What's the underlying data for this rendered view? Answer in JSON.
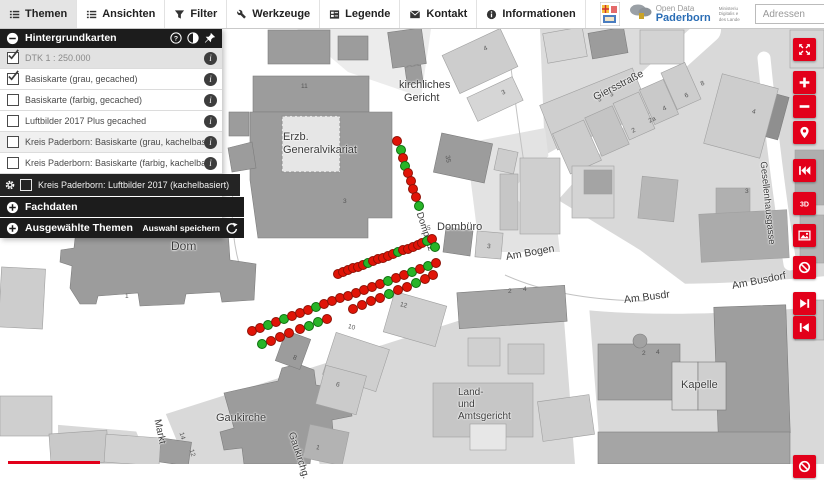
{
  "toolbar": {
    "tabs": [
      {
        "label": "Themen",
        "icon": "list-icon",
        "active": true
      },
      {
        "label": "Ansichten",
        "icon": "list-icon",
        "active": false
      },
      {
        "label": "Filter",
        "icon": "funnel-icon",
        "active": false
      },
      {
        "label": "Werkzeuge",
        "icon": "wrench-icon",
        "active": false
      },
      {
        "label": "Legende",
        "icon": "legend-icon",
        "active": false
      },
      {
        "label": "Kontakt",
        "icon": "mail-icon",
        "active": false
      },
      {
        "label": "Informationen",
        "icon": "info-icon",
        "active": false
      }
    ]
  },
  "brand": {
    "opendata_line1": "Open Data",
    "opendata_line2": "Paderborn",
    "ministry_lines": [
      "Ministeriu",
      "Digitalis e",
      "des Lande"
    ]
  },
  "search": {
    "placeholder": "Adressen",
    "value": ""
  },
  "panel": {
    "header": {
      "title": "Hintergrundkarten"
    },
    "layers": [
      {
        "label": "DTK 1 : 250.000",
        "checked": true,
        "muted": true,
        "info": true
      },
      {
        "label": "Basiskarte (grau, gecached)",
        "checked": true,
        "info": true
      },
      {
        "label": "Basiskarte (farbig, gecached)",
        "checked": false,
        "info": true
      },
      {
        "label": "Luftbilder 2017 Plus gecached",
        "checked": false,
        "info": true
      },
      {
        "label": "Kreis Paderborn: Basiskarte (grau, kachelbasiert)",
        "checked": false,
        "info": true,
        "shaded": true
      },
      {
        "label": "Kreis Paderborn: Basiskarte (farbig, kachelbasiert)",
        "checked": false,
        "info": true
      },
      {
        "label": "Kreis Paderborn: Luftbilder 2017 (kachelbasiert)",
        "checked": false,
        "dark": true,
        "gear": true
      }
    ],
    "sections": [
      {
        "label": "Fachdaten",
        "action": ""
      },
      {
        "label": "Ausgewählte Themen",
        "action": "Auswahl speichern"
      }
    ]
  },
  "map_controls": [
    {
      "name": "fullscreen",
      "icon": "expand-icon",
      "y": 38
    },
    {
      "name": "zoom-in",
      "icon": "plus-icon",
      "y": 71
    },
    {
      "name": "zoom-out",
      "icon": "minus-icon",
      "y": 95
    },
    {
      "name": "locate",
      "icon": "marker-icon",
      "y": 121
    },
    {
      "name": "back-to-start",
      "icon": "rewind-icon",
      "y": 159
    },
    {
      "name": "3d-view",
      "icon": "threed-icon",
      "y": 192
    },
    {
      "name": "background-image",
      "icon": "image-icon",
      "y": 224
    },
    {
      "name": "poi-off",
      "icon": "disable-icon",
      "y": 256
    },
    {
      "name": "step-forward",
      "icon": "stepfwd-icon",
      "y": 292
    },
    {
      "name": "step-back",
      "icon": "stepback-icon",
      "y": 316
    },
    {
      "name": "partial-control",
      "icon": "disable-icon",
      "y": 455
    }
  ],
  "map": {
    "street_labels": [
      {
        "text": "kirchliches",
        "x": 399,
        "y": 79,
        "size": 11,
        "rot": 0
      },
      {
        "text": "Gericht",
        "x": 404,
        "y": 92,
        "size": 11,
        "rot": 0
      },
      {
        "text": "Erzb.",
        "x": 283,
        "y": 131,
        "size": 11,
        "rot": 0
      },
      {
        "text": "Generalvikariat",
        "x": 283,
        "y": 144,
        "size": 11,
        "rot": 0
      },
      {
        "text": "Dom",
        "x": 171,
        "y": 239,
        "size": 12,
        "rot": 0
      },
      {
        "text": "Dombüro",
        "x": 437,
        "y": 221,
        "size": 11,
        "rot": 0
      },
      {
        "text": "Domplatz",
        "x": 419,
        "y": 207,
        "size": 9.5,
        "rot": 72
      },
      {
        "text": "Am Bogen",
        "x": 506,
        "y": 251,
        "size": 10.5,
        "rot": -10
      },
      {
        "text": "Am Busdr",
        "x": 624,
        "y": 294,
        "size": 10.5,
        "rot": -7
      },
      {
        "text": "Am Busdorf",
        "x": 732,
        "y": 280,
        "size": 10.5,
        "rot": -11
      },
      {
        "text": "Giersstraße",
        "x": 594,
        "y": 92,
        "size": 10.5,
        "rot": -27
      },
      {
        "text": "Gesellenhausgasse",
        "x": 763,
        "y": 156,
        "size": 9.5,
        "rot": 84
      },
      {
        "text": "Gaukirche",
        "x": 216,
        "y": 412,
        "size": 11,
        "rot": 0
      },
      {
        "text": "Markt",
        "x": 157,
        "y": 414,
        "size": 10,
        "rot": 78
      },
      {
        "text": "Gaukirchg.",
        "x": 291,
        "y": 427,
        "size": 10,
        "rot": 72
      },
      {
        "text": "Land-",
        "x": 458,
        "y": 387,
        "size": 10,
        "rot": 0
      },
      {
        "text": "und",
        "x": 458,
        "y": 399,
        "size": 10,
        "rot": 0
      },
      {
        "text": "Amtsgericht",
        "x": 458,
        "y": 411,
        "size": 10,
        "rot": 0
      },
      {
        "text": "Kapelle",
        "x": 681,
        "y": 379,
        "size": 11,
        "rot": 0
      }
    ],
    "house_numbers": [
      {
        "text": "11",
        "x": 301,
        "y": 83,
        "rot": 0
      },
      {
        "text": "3",
        "x": 343,
        "y": 198,
        "rot": 0
      },
      {
        "text": "35",
        "x": 447,
        "y": 152,
        "rot": 80
      },
      {
        "text": "1",
        "x": 125,
        "y": 293,
        "rot": 0
      },
      {
        "text": "4",
        "x": 484,
        "y": 46,
        "rot": -25
      },
      {
        "text": "3",
        "x": 502,
        "y": 90,
        "rot": -25
      },
      {
        "text": "3",
        "x": 598,
        "y": 97,
        "rot": -24
      },
      {
        "text": "3",
        "x": 610,
        "y": 92,
        "rot": -24
      },
      {
        "text": "2",
        "x": 632,
        "y": 128,
        "rot": -24
      },
      {
        "text": "2a",
        "x": 649,
        "y": 118,
        "rot": -24
      },
      {
        "text": "4",
        "x": 663,
        "y": 106,
        "rot": -24
      },
      {
        "text": "6",
        "x": 685,
        "y": 93,
        "rot": -24
      },
      {
        "text": "8",
        "x": 701,
        "y": 81,
        "rot": -24
      },
      {
        "text": "4",
        "x": 752,
        "y": 108,
        "rot": 15
      },
      {
        "text": "3",
        "x": 745,
        "y": 188,
        "rot": 0
      },
      {
        "text": "5",
        "x": 427,
        "y": 225,
        "rot": 0
      },
      {
        "text": "3",
        "x": 487,
        "y": 243,
        "rot": 5
      },
      {
        "text": "2",
        "x": 508,
        "y": 288,
        "rot": 0
      },
      {
        "text": "4",
        "x": 523,
        "y": 286,
        "rot": 0
      },
      {
        "text": "2",
        "x": 642,
        "y": 350,
        "rot": 0
      },
      {
        "text": "4",
        "x": 656,
        "y": 349,
        "rot": 0
      },
      {
        "text": "12",
        "x": 400,
        "y": 301,
        "rot": 15
      },
      {
        "text": "10",
        "x": 348,
        "y": 323,
        "rot": 15
      },
      {
        "text": "8",
        "x": 293,
        "y": 354,
        "rot": 20
      },
      {
        "text": "6",
        "x": 336,
        "y": 381,
        "rot": 15
      },
      {
        "text": "1",
        "x": 316,
        "y": 444,
        "rot": 12
      },
      {
        "text": "14",
        "x": 181,
        "y": 429,
        "rot": 75
      },
      {
        "text": "12",
        "x": 191,
        "y": 446,
        "rot": 75
      }
    ],
    "dots": [
      [
        396,
        140,
        "r"
      ],
      [
        400,
        149,
        "g"
      ],
      [
        402,
        157,
        "r"
      ],
      [
        404,
        165,
        "g"
      ],
      [
        407,
        172,
        "r"
      ],
      [
        410,
        180,
        "r"
      ],
      [
        412,
        188,
        "r"
      ],
      [
        415,
        196,
        "r"
      ],
      [
        418,
        205,
        "g"
      ],
      [
        337,
        273,
        "r"
      ],
      [
        342,
        271,
        "r"
      ],
      [
        347,
        269,
        "r"
      ],
      [
        352,
        267,
        "r"
      ],
      [
        357,
        266,
        "r"
      ],
      [
        362,
        264,
        "r"
      ],
      [
        367,
        262,
        "g"
      ],
      [
        372,
        260,
        "r"
      ],
      [
        377,
        258,
        "r"
      ],
      [
        382,
        257,
        "r"
      ],
      [
        387,
        255,
        "r"
      ],
      [
        392,
        253,
        "r"
      ],
      [
        397,
        251,
        "g"
      ],
      [
        402,
        249,
        "r"
      ],
      [
        407,
        248,
        "r"
      ],
      [
        412,
        246,
        "r"
      ],
      [
        417,
        244,
        "r"
      ],
      [
        421,
        242,
        "r"
      ],
      [
        426,
        240,
        "g"
      ],
      [
        431,
        238,
        "r"
      ],
      [
        434,
        246,
        "g"
      ],
      [
        251,
        330,
        "r"
      ],
      [
        259,
        327,
        "r"
      ],
      [
        267,
        324,
        "g"
      ],
      [
        275,
        321,
        "r"
      ],
      [
        283,
        318,
        "g"
      ],
      [
        291,
        315,
        "r"
      ],
      [
        299,
        312,
        "r"
      ],
      [
        307,
        309,
        "r"
      ],
      [
        315,
        306,
        "g"
      ],
      [
        323,
        303,
        "r"
      ],
      [
        331,
        300,
        "r"
      ],
      [
        339,
        297,
        "r"
      ],
      [
        347,
        295,
        "r"
      ],
      [
        355,
        292,
        "r"
      ],
      [
        363,
        289,
        "r"
      ],
      [
        371,
        286,
        "r"
      ],
      [
        379,
        283,
        "r"
      ],
      [
        387,
        280,
        "g"
      ],
      [
        395,
        277,
        "r"
      ],
      [
        403,
        274,
        "r"
      ],
      [
        411,
        271,
        "g"
      ],
      [
        419,
        268,
        "r"
      ],
      [
        427,
        265,
        "g"
      ],
      [
        435,
        262,
        "r"
      ],
      [
        261,
        343,
        "g"
      ],
      [
        270,
        340,
        "r"
      ],
      [
        279,
        336,
        "r"
      ],
      [
        288,
        332,
        "r"
      ],
      [
        299,
        328,
        "r"
      ],
      [
        308,
        325,
        "g"
      ],
      [
        317,
        321,
        "g"
      ],
      [
        326,
        318,
        "r"
      ],
      [
        352,
        308,
        "r"
      ],
      [
        361,
        304,
        "r"
      ],
      [
        370,
        300,
        "r"
      ],
      [
        379,
        297,
        "r"
      ],
      [
        388,
        293,
        "g"
      ],
      [
        397,
        289,
        "r"
      ],
      [
        406,
        286,
        "r"
      ],
      [
        415,
        282,
        "g"
      ],
      [
        424,
        278,
        "r"
      ],
      [
        432,
        274,
        "r"
      ]
    ]
  },
  "colors": {
    "accent_red": "#e2001a",
    "marker_red": "#e01407",
    "marker_green": "#28b428",
    "brand_blue": "#2a6db5",
    "panel_dark": "#1c1c1c"
  }
}
